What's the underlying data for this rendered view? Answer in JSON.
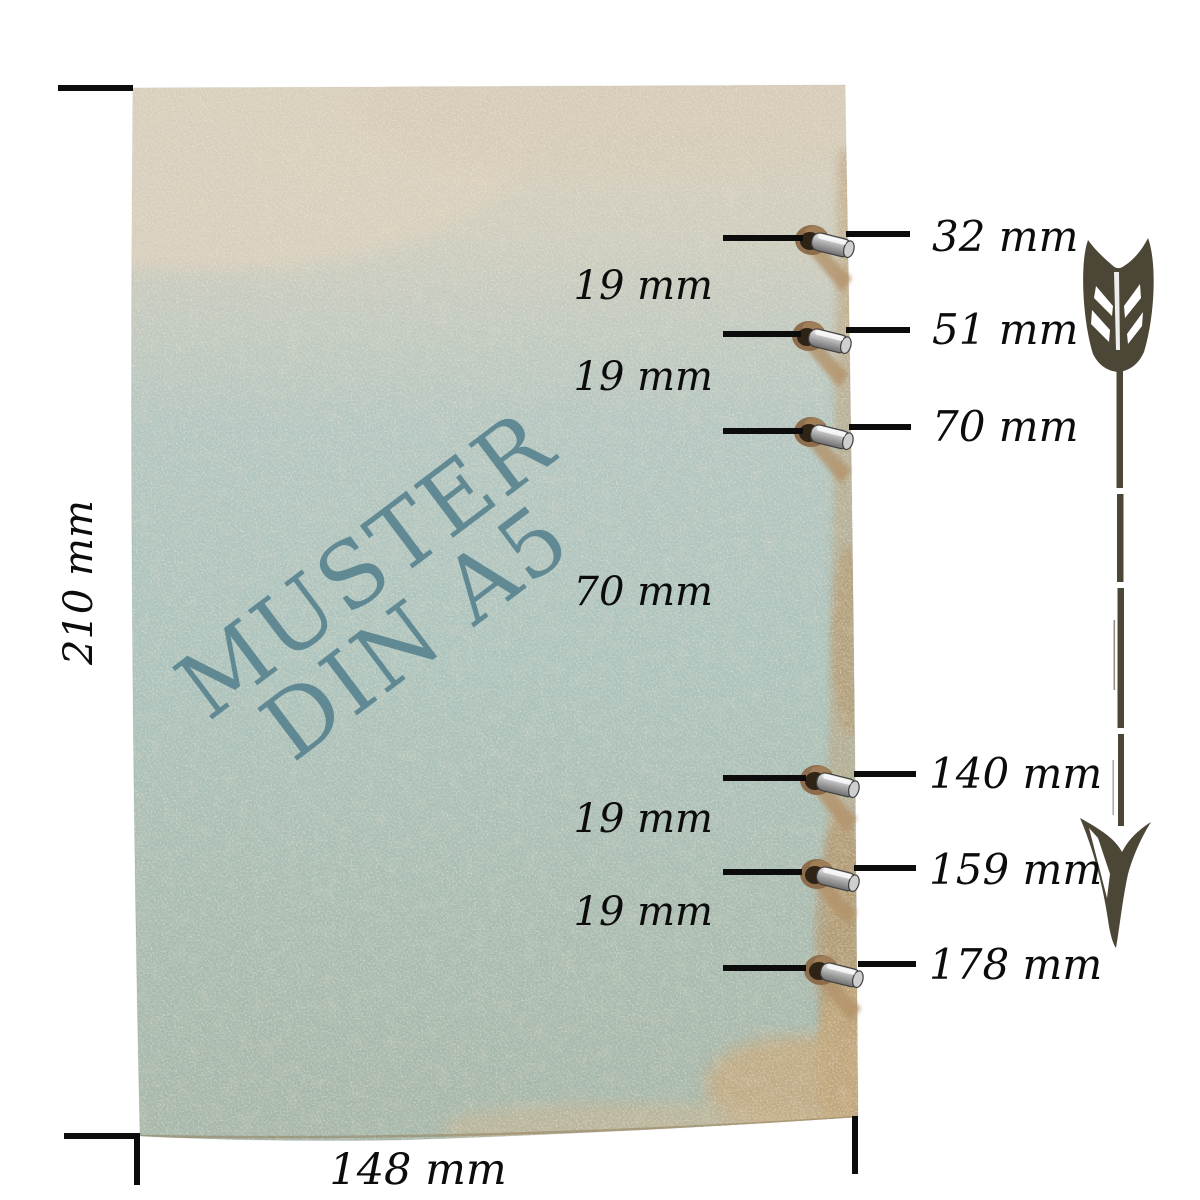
{
  "image": {
    "watermark": {
      "line1": "MUSTER",
      "line2": "DIN A5"
    },
    "dimensions": {
      "height": "210 mm",
      "width": "148 mm"
    },
    "hole_positions": [
      {
        "text": "32 mm"
      },
      {
        "text": "51 mm"
      },
      {
        "text": "70 mm"
      },
      {
        "text": "140 mm"
      },
      {
        "text": "159 mm"
      },
      {
        "text": "178 mm"
      }
    ],
    "hole_spacings": [
      {
        "text": "19 mm"
      },
      {
        "text": "19 mm"
      },
      {
        "text": "70 mm"
      },
      {
        "text": "19 mm"
      },
      {
        "text": "19 mm"
      }
    ],
    "icons": {
      "arrow": "down-arrow-icon",
      "eyelet": "eyelet-ring-icon"
    },
    "colors": {
      "watermark": "#55818e",
      "arrow": "#4b4636",
      "line": "#0c0c0c",
      "paper_beige": "#d8cdbb",
      "paper_teal": "#adc4bf",
      "paper_green": "#a4b6aa",
      "stain_tan": "#b9996e"
    }
  }
}
